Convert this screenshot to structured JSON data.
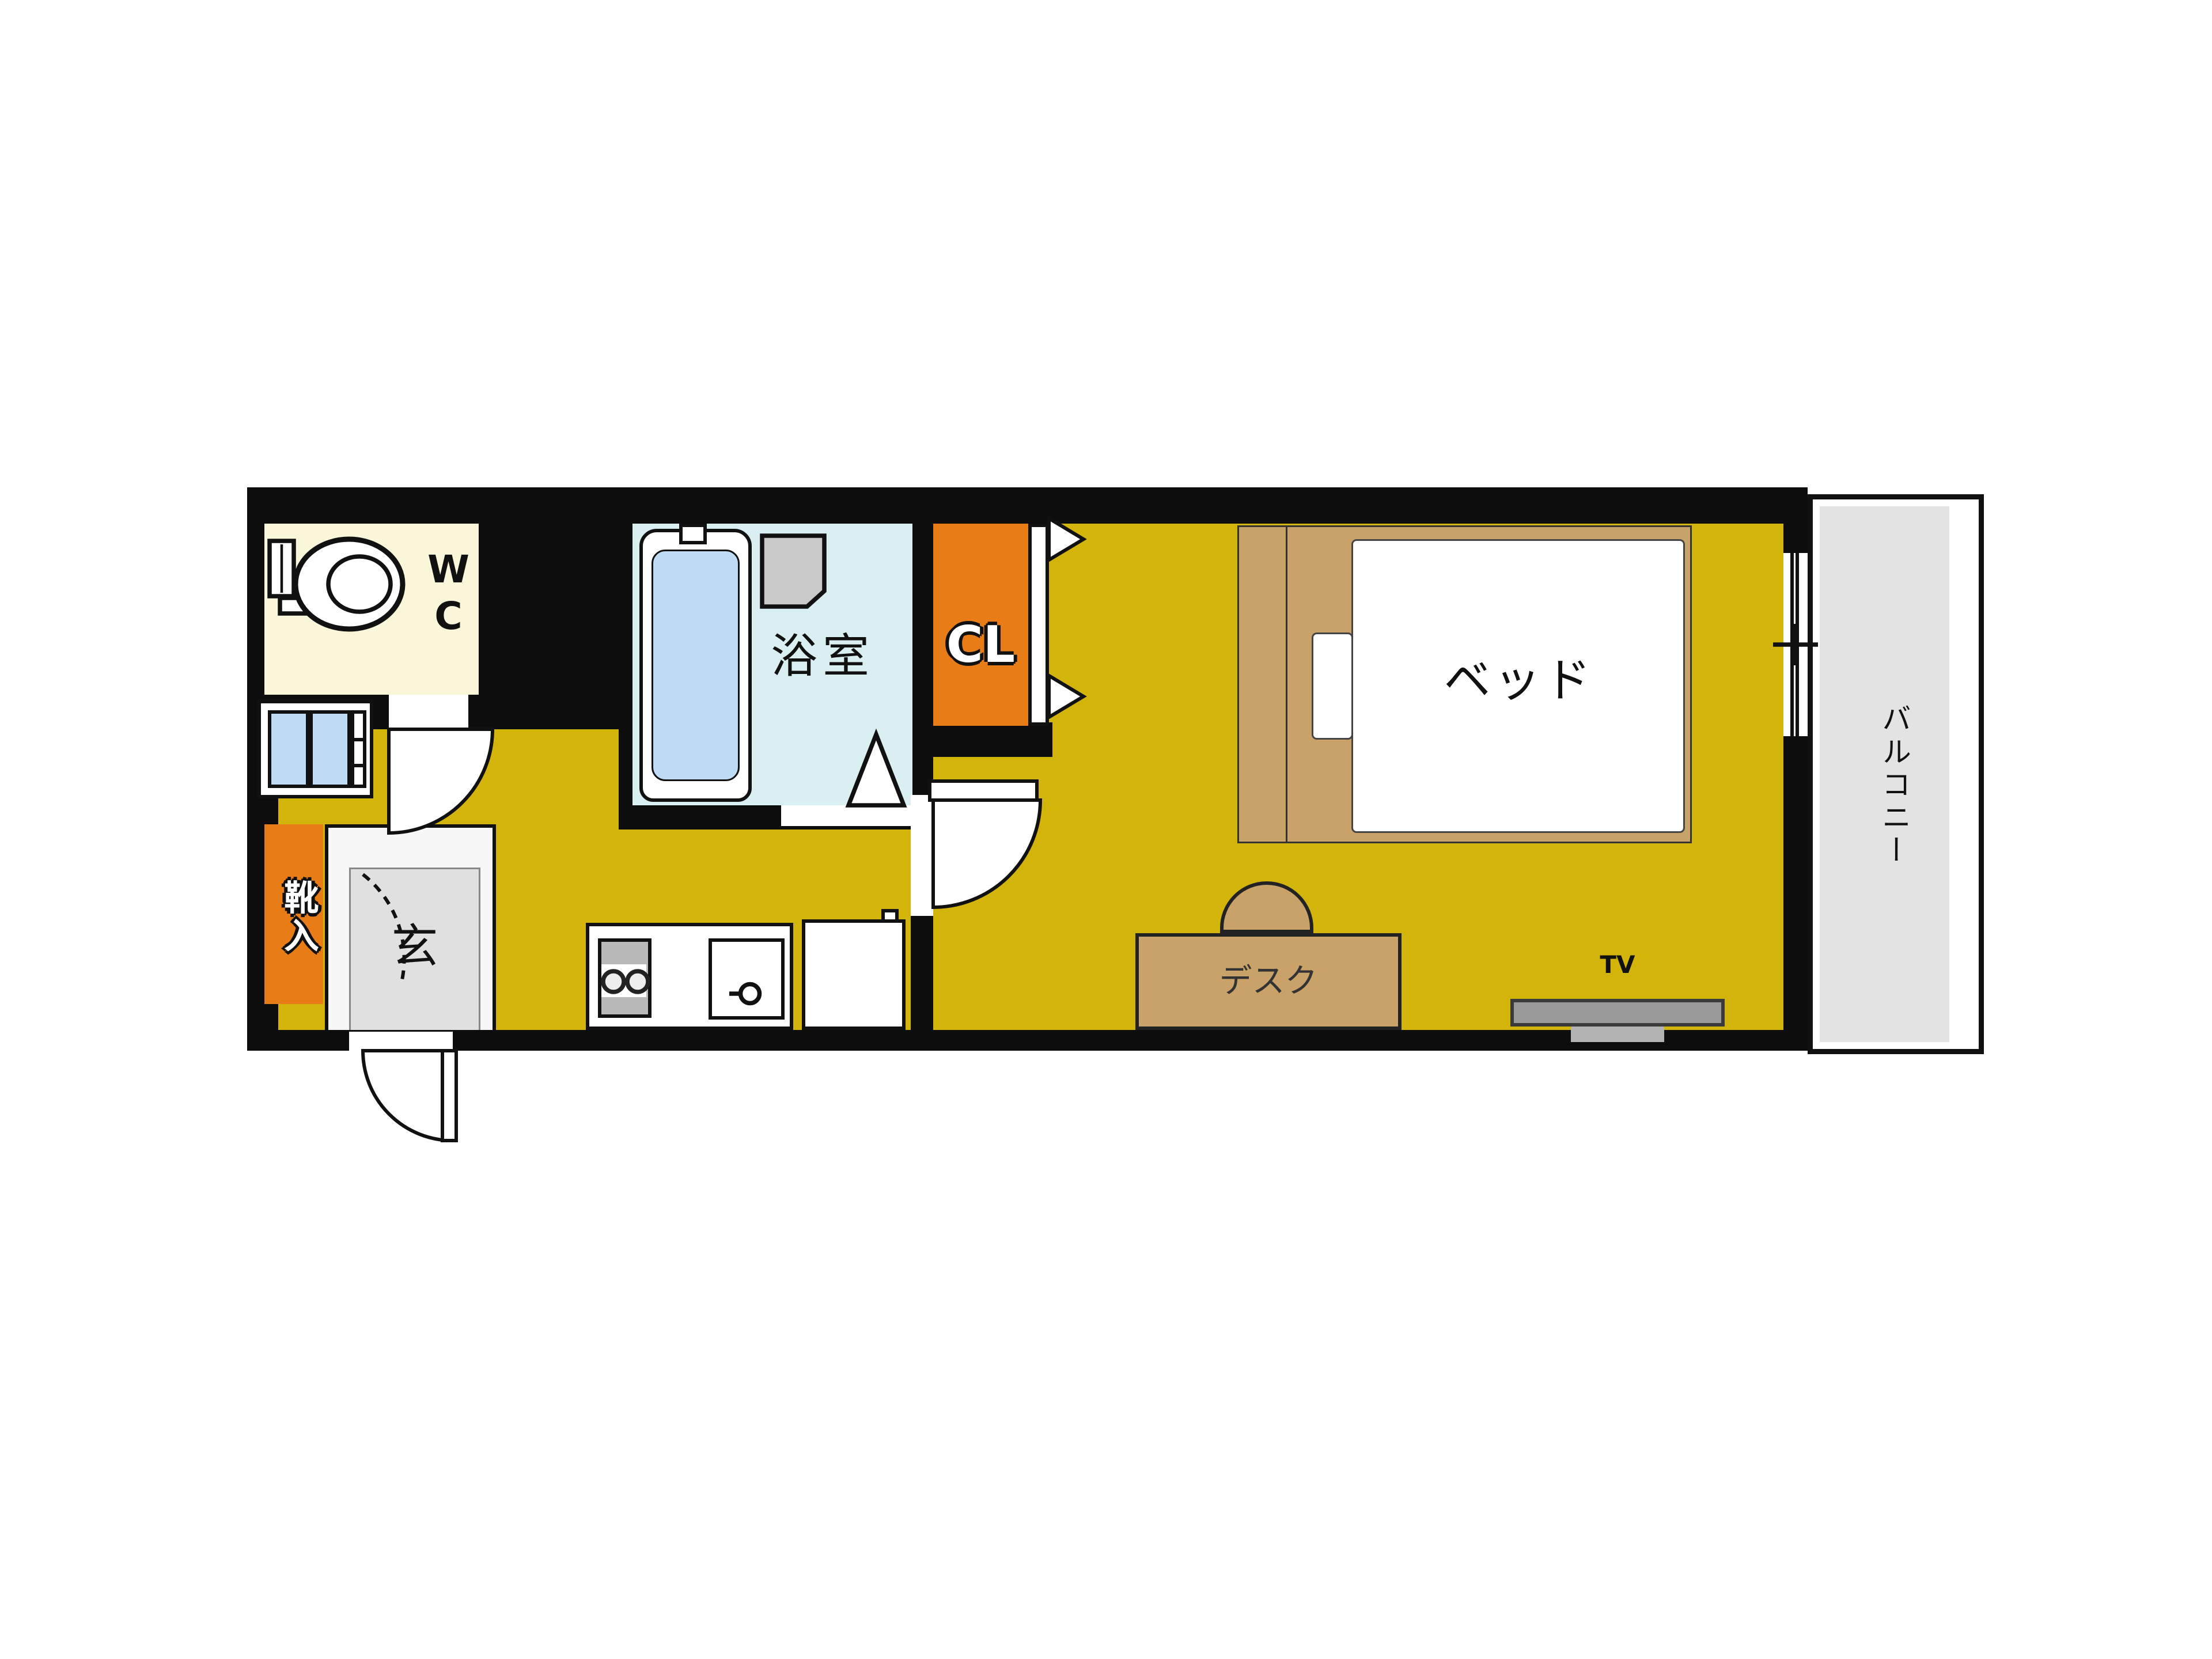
{
  "plan": {
    "type": "apartment-floorplan",
    "rooms": {
      "wc": {
        "label": "WC"
      },
      "bathroom": {
        "label": "浴室"
      },
      "closet": {
        "label": "CL"
      },
      "entrance": {
        "label": "玄"
      },
      "shoe_cabinet": {
        "label": "靴入"
      },
      "balcony": {
        "label": "バルコニー"
      }
    },
    "furniture": {
      "bed": {
        "label": "ベッド"
      },
      "desk": {
        "label": "デスク"
      },
      "tv": {
        "label": "TV"
      }
    },
    "colors": {
      "wall": "#0d0d0d",
      "floor_yellow": "#d2b40a",
      "wc_cream": "#faf6da",
      "bath_cyan": "#daeff1",
      "accent_orange": "#e87d18",
      "water_blue": "#bedcf5",
      "balcony_gray": "#e3e3e3",
      "furniture_tan": "#c8a269",
      "tv_gray": "#999999"
    }
  }
}
